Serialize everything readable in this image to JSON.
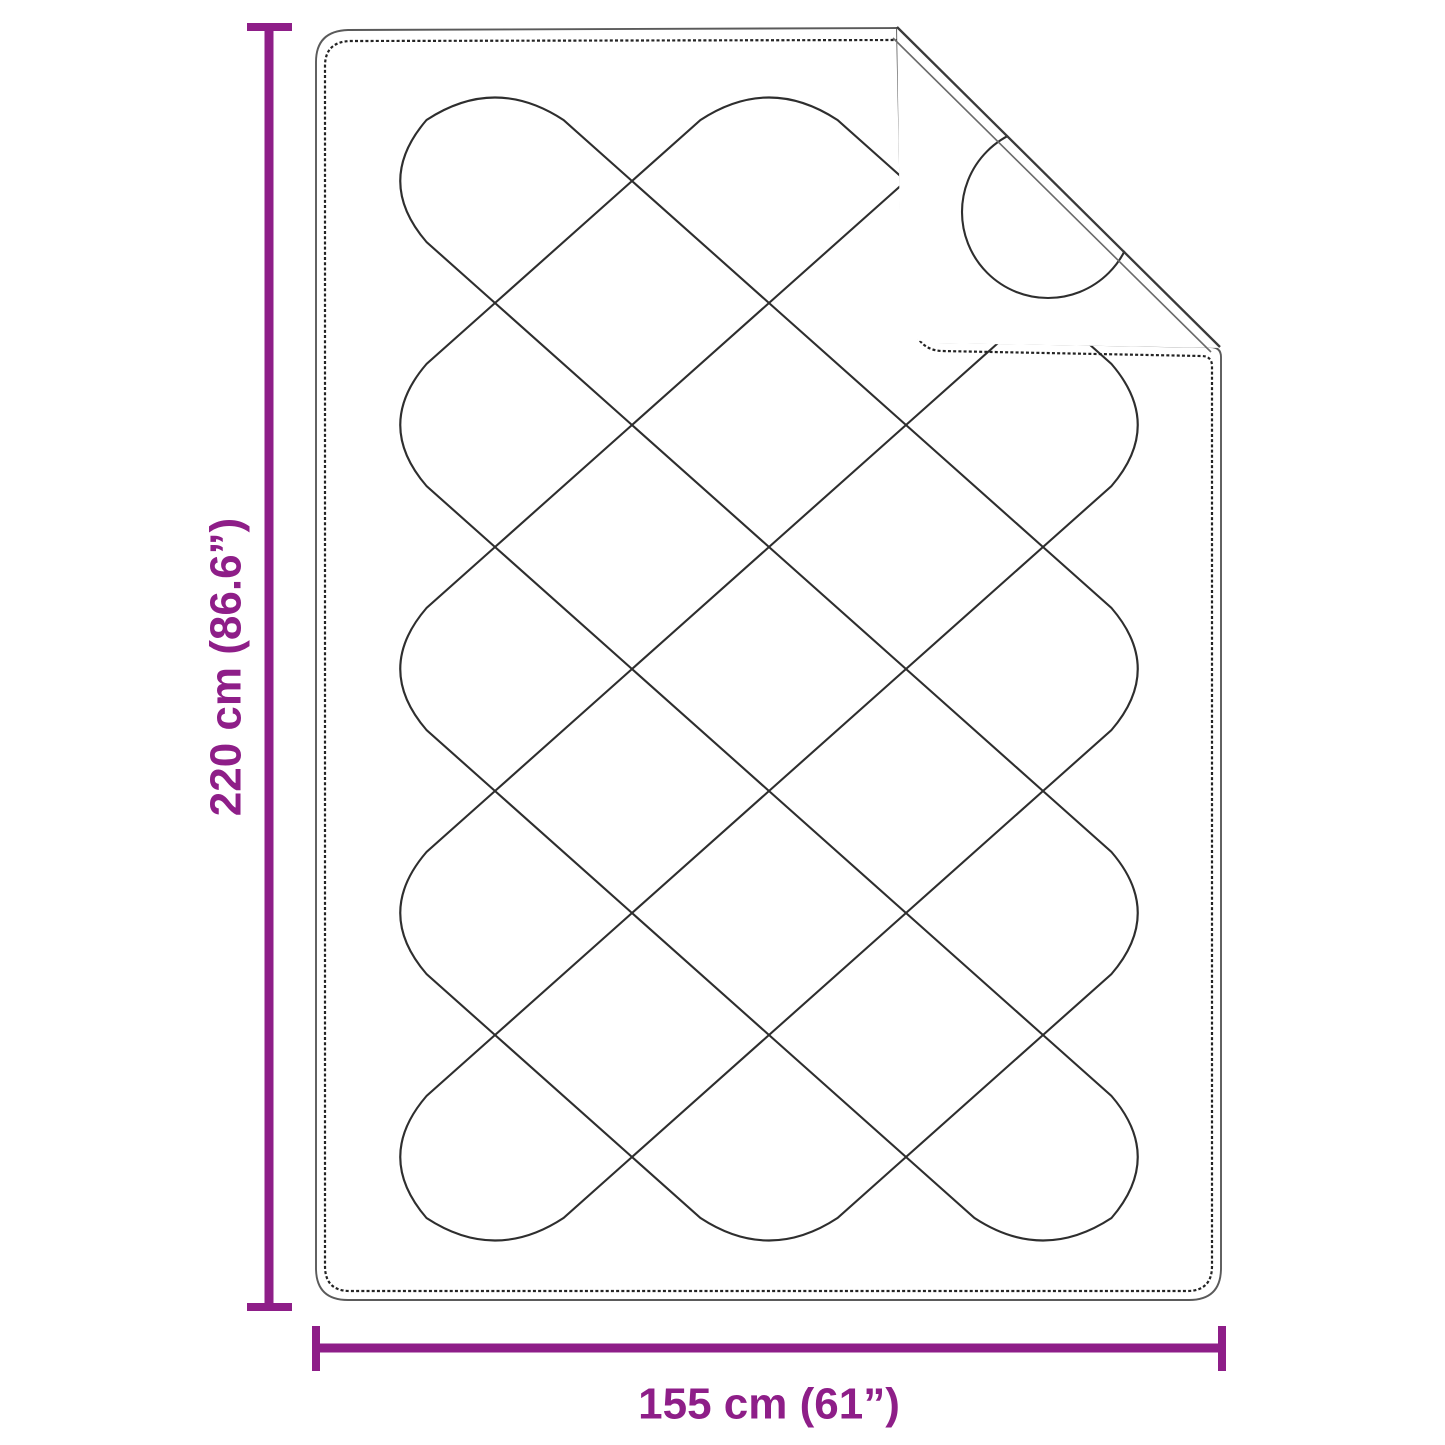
{
  "figure": {
    "type": "product-dimension-diagram",
    "subject": "quilted-blanket-with-folded-corner",
    "height_label": "220 cm (86.6”)",
    "width_label": "155 cm (61”)",
    "colors": {
      "accent": "#8E1E88",
      "stitch_line": "#2e2e2e",
      "edge_line": "#5a5a5a",
      "background": "#ffffff"
    }
  }
}
